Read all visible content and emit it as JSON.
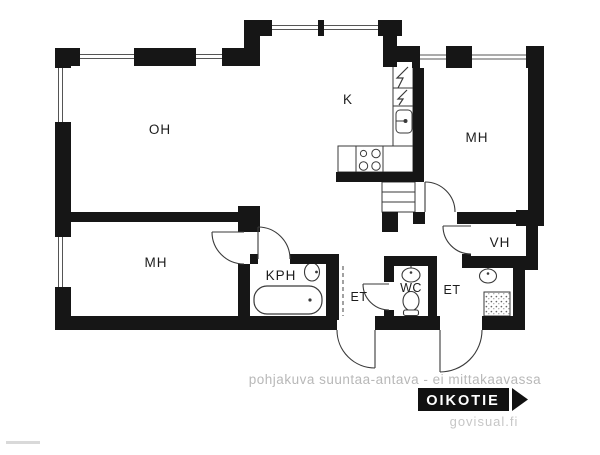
{
  "rooms": {
    "living": {
      "label": "OH"
    },
    "kitchen": {
      "label": "K"
    },
    "bedroom_right": {
      "label": "MH"
    },
    "bedroom_left": {
      "label": "MH"
    },
    "closet": {
      "label": "VH"
    },
    "bathroom": {
      "label": "KPH"
    },
    "hall_1": {
      "label": "ET"
    },
    "toilet_room": {
      "label": "WC"
    },
    "hall_2": {
      "label": "ET"
    }
  },
  "footer": {
    "disclaimer": "pohjakuva suuntaa-antava - ei mittakaavassa",
    "brand": "OIKOTIE",
    "credit": "govisual.fi"
  },
  "colors": {
    "wall": "#161616",
    "fixture_line": "#3a3a3a",
    "muted_text": "#b8b8b8",
    "brand_bg": "#111111",
    "brand_text": "#ffffff",
    "background": "#ffffff"
  }
}
